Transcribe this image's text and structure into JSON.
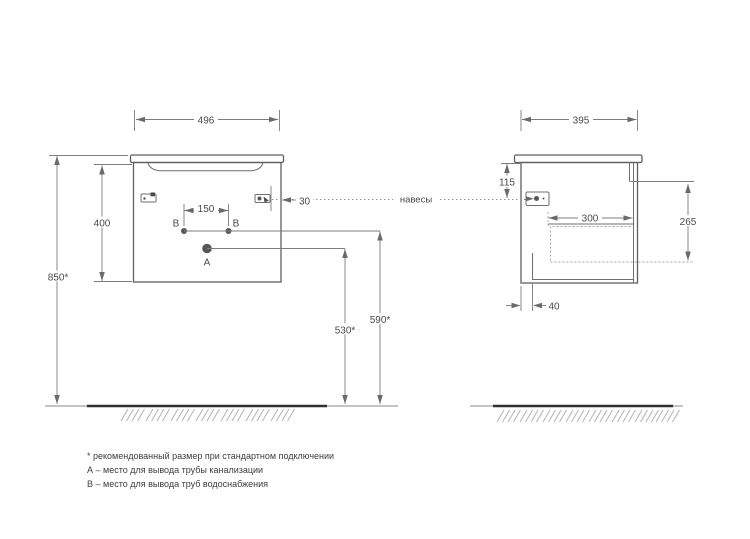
{
  "dims": {
    "front": {
      "width": "496",
      "body_height": "400",
      "total_height": "850*",
      "b_spacing": "150",
      "hanger_offset": "30",
      "a_height": "530*",
      "b_height": "590*"
    },
    "side": {
      "depth": "395",
      "hanger_drop": "115",
      "drawer_depth": "300",
      "inner_height": "265",
      "bottom_offset": "40"
    }
  },
  "labels": {
    "hangers": "навесы",
    "hole_a": "A",
    "hole_b": "B"
  },
  "footnotes": {
    "asterisk": "* рекомендованный размер при стандартном подключении",
    "a": "А – место для вывода трубы канализации",
    "b": "В – место для вывода труб водоснабжения"
  },
  "colors": {
    "line": "#5f5f5f",
    "dimension": "#7d7d7d",
    "floor": "#303030",
    "background": "#ffffff"
  }
}
